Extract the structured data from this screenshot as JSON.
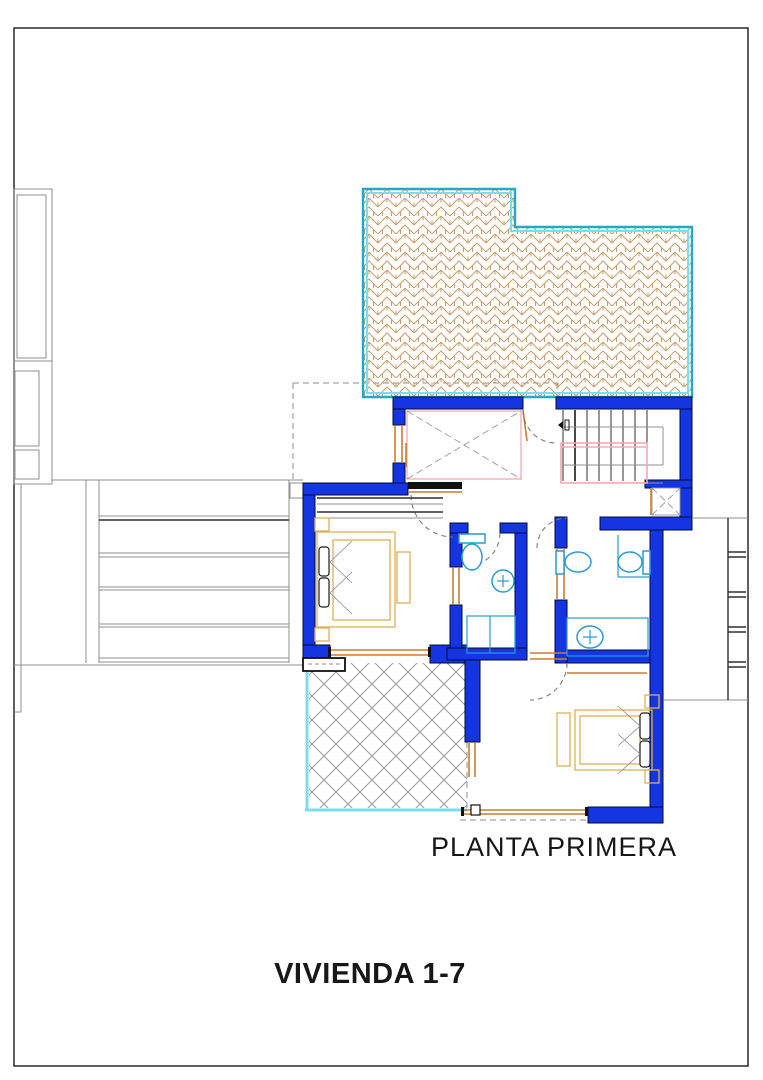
{
  "drawing": {
    "floor_label": "PLANTA PRIMERA",
    "unit_label": "VIVIENDA 1-7"
  },
  "colors": {
    "wall_blue": "#1535e0",
    "terrace_cyan_dark": "#23a9c0",
    "terrace_cyan_light": "#79dfee",
    "hatch_tan": "#c79d6b",
    "diamond_gray": "#9a9a9a",
    "furniture_gold": "#ddb057",
    "jamb_orange": "#c87f35",
    "fixture_blue": "#2a9ad4",
    "stair_pink": "#f2aab2",
    "dash_gray": "#8f8f8f",
    "neighbor_gray": "#8f8f8f"
  }
}
